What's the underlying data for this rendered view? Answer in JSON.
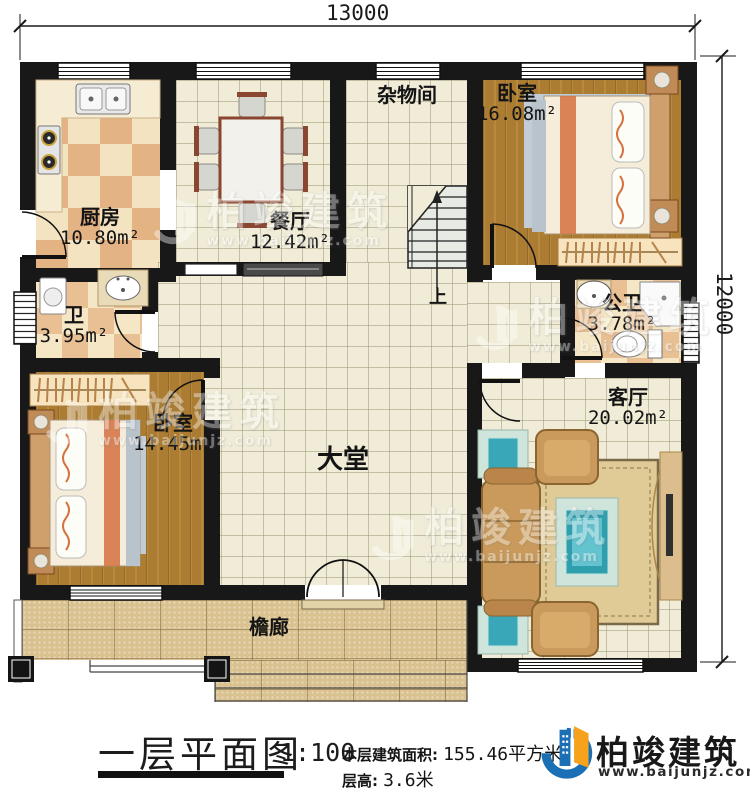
{
  "plan": {
    "dimensions": {
      "width_mm": "13000",
      "height_mm": "12000"
    },
    "rooms": {
      "kitchen": {
        "name": "厨房",
        "area": "10.80m²"
      },
      "dining": {
        "name": "餐厅",
        "area": "12.42m²"
      },
      "storage": {
        "name": "杂物间"
      },
      "bedroom_top": {
        "name": "卧室",
        "area": "16.08m²"
      },
      "bath": {
        "name": "卫",
        "area": "3.95m²"
      },
      "public_bath": {
        "name": "公卫",
        "area": "3.78m²"
      },
      "bedroom_left": {
        "name": "卧室",
        "area": "14.45m²"
      },
      "hall": {
        "name": "大堂"
      },
      "living": {
        "name": "客厅",
        "area": "20.02m²"
      },
      "porch": {
        "name": "檐廊"
      }
    },
    "stairs_up_label": "上"
  },
  "title_block": {
    "title": "一层平面图",
    "scale": "1:100",
    "area_label": "本层建筑面积:",
    "area_value": "155.46平方米",
    "height_label": "层高:",
    "height_value": "3.6米"
  },
  "brand": {
    "name": "柏竣建筑",
    "website": "www.baijunjz.com",
    "logo_icon": "building-swoosh-logo-icon"
  },
  "watermark": {
    "name": "柏竣建筑",
    "website": "www.baijunjz.com"
  },
  "colors": {
    "wall": "#181818",
    "wood": "#ab7c31",
    "tile": "#f0ecd8",
    "checker_light": "#f3e3c1",
    "checker_dark": "#e4b384",
    "porch_stone": "#d9c28f",
    "brand_blue": "#1a6fb5",
    "brand_orange": "#f6a21d"
  }
}
